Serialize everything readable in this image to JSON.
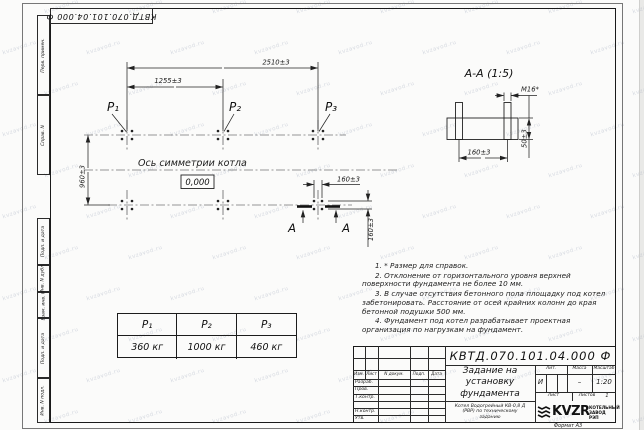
{
  "watermark": {
    "text": "kvzavod.ru"
  },
  "stamp": {
    "designation": "КВТД.070.101.04.000 Ф"
  },
  "margins": {
    "top": [
      "Перв. примен.",
      "Справ. N"
    ],
    "bottom": [
      "Подп. и дата",
      "Инв. N дубл.",
      "Взам. инв. N",
      "Подп. и дата",
      "Инв. N подл."
    ]
  },
  "plan": {
    "dim_total_width": "2510±3",
    "dim_half_width": "1255±3",
    "dim_depth": "960±3",
    "dim_bolt_spacing_x": "160±3",
    "dim_bolt_spacing_y": "160±3",
    "axis_label": "Ось симметрии котла",
    "elevation_mark": "0,000",
    "p1": "P₁",
    "p2": "P₂",
    "p3": "P₃",
    "section_letter": "А"
  },
  "section": {
    "title": "А-А (1:5)",
    "thread_label": "М16*",
    "dim_bolt_spacing": "160±3",
    "dim_embed_depth": "50±3"
  },
  "load_table": {
    "headers": [
      "P₁",
      "P₂",
      "P₃"
    ],
    "values": [
      "360 кг",
      "1000 кг",
      "460 кг"
    ]
  },
  "notes": [
    "1. * Размер для справок.",
    "2. Отклонение от горизонтального уровня верхней поверхности фундамента не более 10 мм.",
    "3. В случае отсутствия бетонного пола площадку под котел забетонировать. Расстояние от осей крайних колонн до края бетонной подушки 500 мм.",
    "4. Фундамент под котел разрабатывает проектная организация по нагрузкам на фундамент."
  ],
  "title_block": {
    "designation": "КВТД.070.101.04.000 Ф",
    "doc_title": "Задание на установку фундамента",
    "product_desc": "Котел Водогрейный КВ-0,8 Д (РВР) по техническому заданию",
    "change_cols": [
      "Изм.",
      "Лист",
      "N докум.",
      "Подп.",
      "Дата"
    ],
    "sign_rows": [
      "Разраб.",
      "Пров.",
      "Т.контр.",
      "Н.контр.",
      "Утв."
    ],
    "lit_header": "Лит.",
    "lit_value": "И",
    "mass_header": "Масса",
    "mass_value": "–",
    "scale_header": "Масштаб",
    "scale_value": "1:20",
    "sheet_header": "Лист",
    "sheets_header": "Листов",
    "sheets_value": "1",
    "logo_text": "KVZR",
    "logo_sub": "КОТЕЛЬНЫЙ ЗАВОД РЭП",
    "format_note": "Формат А3"
  }
}
